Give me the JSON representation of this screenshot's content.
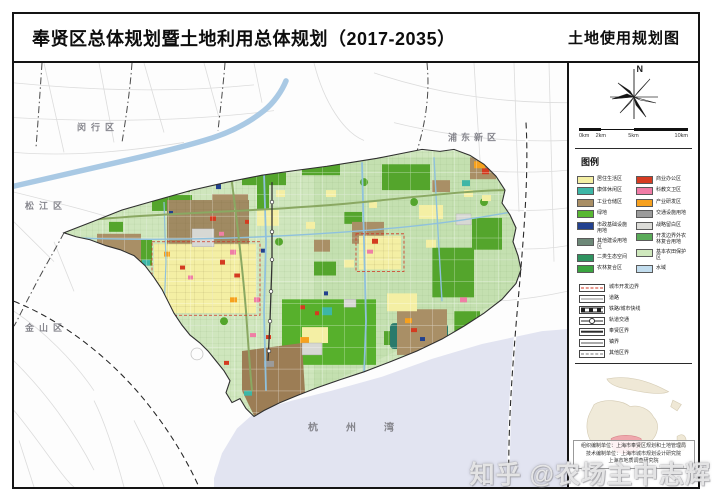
{
  "header": {
    "title": "奉贤区总体规划暨土地利用总体规划（2017-2035）",
    "map_name": "土地使用规划图"
  },
  "compass": {
    "label": "N"
  },
  "scalebar": {
    "ticks": [
      "0km",
      "2km",
      "5km",
      "10km"
    ]
  },
  "legend": {
    "title": "图例",
    "zones_left": [
      {
        "label": "居住生活区",
        "color": "#f4efa4"
      },
      {
        "label": "康体休闲区",
        "color": "#3db6a6"
      },
      {
        "label": "工业仓储区",
        "color": "#a98f66"
      },
      {
        "label": "绿地",
        "color": "#58b832"
      },
      {
        "label": "市政基础设施用地",
        "color": "#23418f"
      },
      {
        "label": "其他建设用地区",
        "color": "#6d8878"
      },
      {
        "label": "二类生态空间",
        "color": "#2f9360"
      },
      {
        "label": "农林复合区",
        "color": "#3aa440"
      }
    ],
    "zones_right": [
      {
        "label": "商业办公区",
        "color": "#d63b21"
      },
      {
        "label": "科教文卫区",
        "color": "#f07ca6"
      },
      {
        "label": "产业研发区",
        "color": "#f7a11f"
      },
      {
        "label": "交通设施用地",
        "color": "#9b9b9b"
      },
      {
        "label": "战略留白区",
        "color": "#dcdcd8"
      },
      {
        "label": "开发边界外农林复合用地",
        "color": "#5aab59"
      },
      {
        "label": "基本农田保护区",
        "color": "#cfe8bd"
      },
      {
        "label": "水域",
        "color": "#c2ddee"
      }
    ],
    "lines": [
      {
        "label": "城市开发边界",
        "symbol": "red-dash-box"
      },
      {
        "label": "道路",
        "symbol": "road"
      },
      {
        "label": "铁路/城市快线",
        "symbol": "railway"
      },
      {
        "label": "轨道交通",
        "symbol": "metro"
      },
      {
        "label": "奉贤区界",
        "symbol": "district-boundary"
      },
      {
        "label": "镇界",
        "symbol": "town-boundary"
      },
      {
        "label": "其他区界",
        "symbol": "other-boundary"
      }
    ]
  },
  "map": {
    "labels": [
      {
        "text": "闵行区",
        "x": 63,
        "y": 68,
        "ls": 5,
        "fs": 9
      },
      {
        "text": "浦东新区",
        "x": 434,
        "y": 78,
        "ls": 4,
        "fs": 9
      },
      {
        "text": "松江区",
        "x": 11,
        "y": 147,
        "ls": 5,
        "fs": 9
      },
      {
        "text": "金山区",
        "x": 11,
        "y": 270,
        "ls": 5,
        "fs": 9
      },
      {
        "text": "杭州湾",
        "x": 294,
        "y": 370,
        "ls": 28,
        "fs": 10
      }
    ]
  },
  "credits": {
    "lines": [
      "组织编制单位：上海市奉贤区规划和土地管理局",
      "技术编制单位：上海市城市规划设计研究院",
      "上海市地质调查研究院"
    ]
  },
  "watermark": "知乎 @农场主中志辉"
}
